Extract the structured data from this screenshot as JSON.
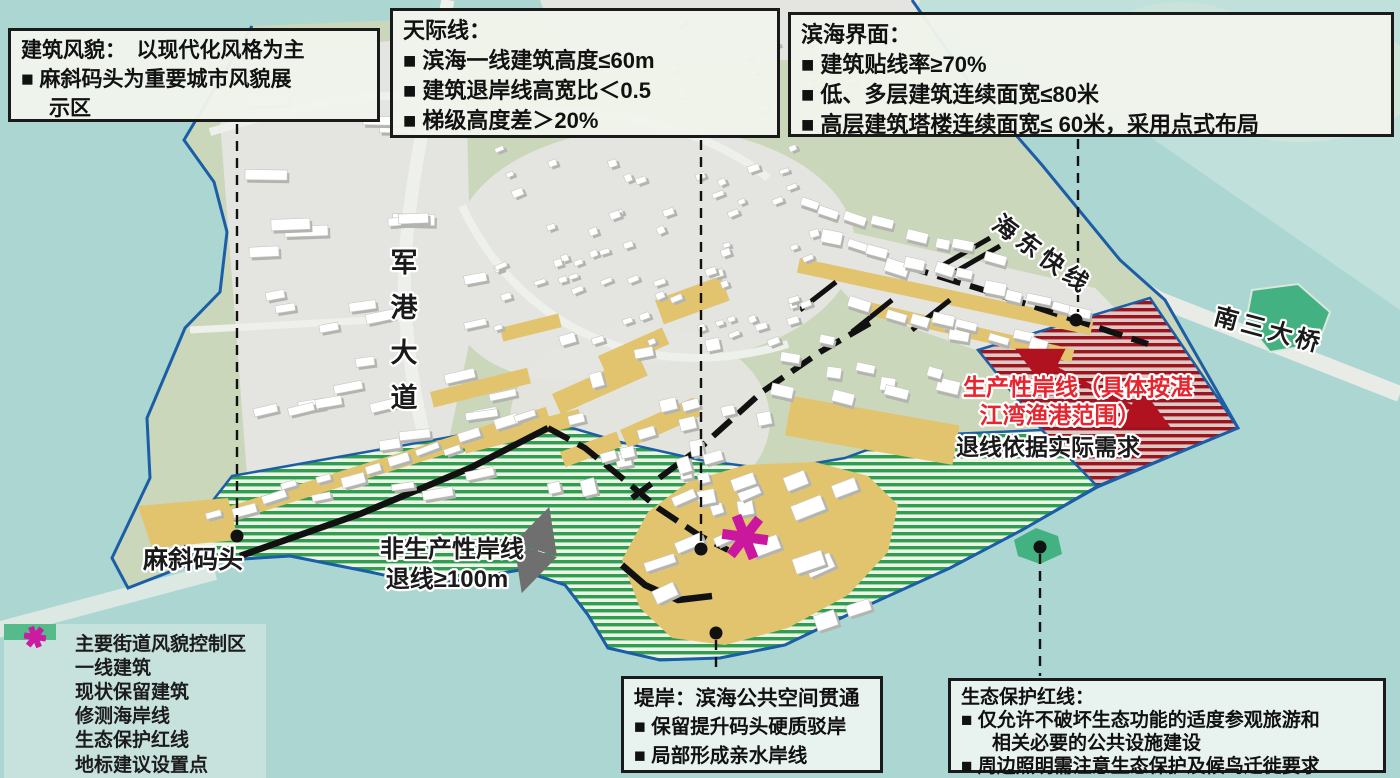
{
  "colors": {
    "water": "#ABD6D2",
    "land_green": "#CBD7BA",
    "urban_gray": "#E4E5E1",
    "frontline_yellow": "#E2C36E",
    "coastline_blue": "#1B5EA6",
    "eco_hatch_green": "#2F9E53",
    "productive_hatch_red": "#9C1420",
    "landmark_magenta": "#C9189D",
    "street_black": "#111111",
    "red_label": "#E6252F"
  },
  "info_boxes": {
    "style": {
      "title": "建筑风貌：　以现代化风格为主",
      "line1": "■ 麻斜码头为重要城市风貌展",
      "line2": "示区"
    },
    "skyline": {
      "title": "天际线：",
      "line1": "■ 滨海一线建筑高度≤60m",
      "line2": "■ 建筑退岸线高宽比＜0.5",
      "line3": "■ 梯级高度差＞20%"
    },
    "seafront": {
      "title": "滨海界面：",
      "line1": "■ 建筑贴线率≥70%",
      "line2": "■ 低、多层建筑连续面宽≤80米",
      "line3": "■ 高层建筑塔楼连续面宽≤ 60米，采用点式布局"
    },
    "embankment": {
      "title": "堤岸：滨海公共空间贯通",
      "line1": "■ 保留提升码头硬质驳岸",
      "line2": "■ 局部形成亲水岸线"
    },
    "ecology": {
      "title": "生态保护红线：",
      "line1": "■ 仅允许不破坏生态功能的适度参观旅游和",
      "line1b": "相关必要的公共设施建设",
      "line2": "■ 周边照明需注意生态保护及候鸟迁徙要求"
    }
  },
  "legend": {
    "items": [
      {
        "label": "主要街道风貌控制区",
        "color": "#EB9D71"
      },
      {
        "label": "一线建筑",
        "color": "#E5C76F"
      },
      {
        "label": "现状保留建筑",
        "color": "#C9C9C9"
      },
      {
        "label": "修测海岸线",
        "color": "#1C5BA6"
      },
      {
        "label": "生态保护红线",
        "color": "#56BB8A"
      },
      {
        "label": "地标建议设置点",
        "color": "#CB1BA0"
      }
    ]
  },
  "map": {
    "labels": {
      "majie_wharf": "麻斜码头",
      "junggang_avenue_chars": [
        "军",
        "港",
        "大",
        "道"
      ],
      "haidong_expressway": "海东快线",
      "nansan_bridge": "南三大桥",
      "productive_shoreline_1": "生产性岸线（具体按湛",
      "productive_shoreline_2": "江湾渔港范围）",
      "setback_by_need": "退线依据实际需求",
      "nonproductive_shoreline": "非生产性岸线",
      "nonproductive_setback": "退线≥100m"
    }
  }
}
